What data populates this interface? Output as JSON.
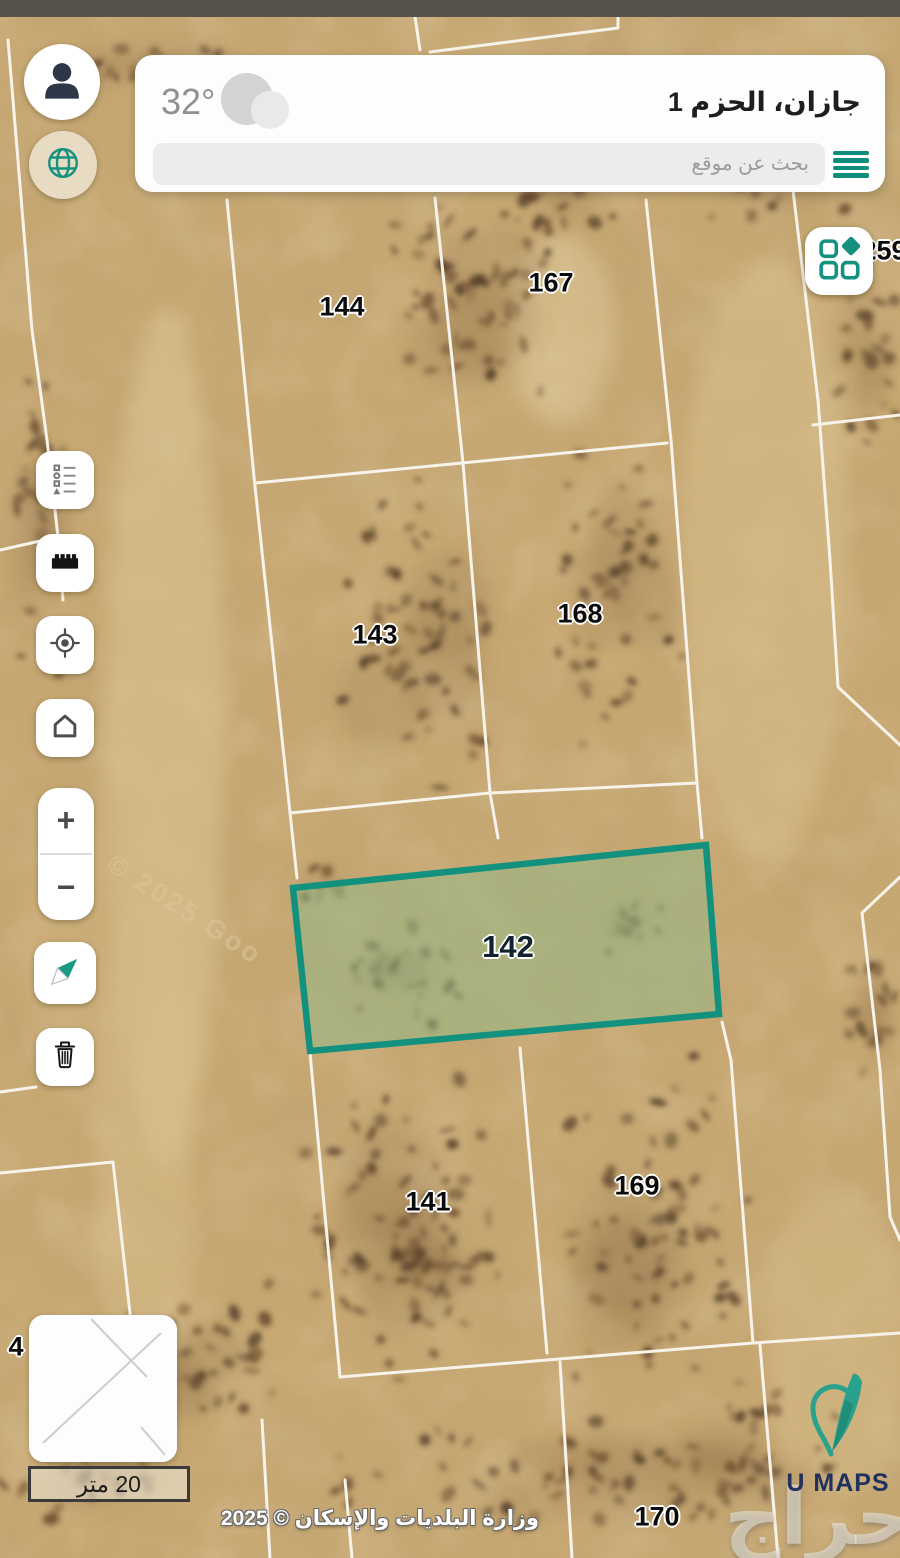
{
  "header": {
    "temperature": "32°",
    "weather_icon": "cloud-icon",
    "location_title": "جازان، الحزم 1",
    "search_placeholder": "بحث عن موقع",
    "menu_icon": "hamburger-icon"
  },
  "quick_buttons": {
    "profile_icon": "person-icon",
    "language_icon": "globe-icon"
  },
  "layers_panel": {
    "icon": "layers-grid-icon"
  },
  "toolbar": {
    "items": [
      {
        "name": "legend",
        "icon": "legend-list-icon"
      },
      {
        "name": "measure",
        "icon": "ruler-icon"
      },
      {
        "name": "locate",
        "icon": "gps-target-icon"
      },
      {
        "name": "home",
        "icon": "home-icon"
      }
    ]
  },
  "zoom_controls": {
    "zoom_in": "+",
    "zoom_out": "−"
  },
  "map_tools": {
    "compass_icon": "compass-needle-icon",
    "delete_icon": "trash-icon"
  },
  "map": {
    "parcel_labels": [
      {
        "label": "144"
      },
      {
        "label": "167"
      },
      {
        "label": "143"
      },
      {
        "label": "168"
      },
      {
        "label": "141"
      },
      {
        "label": "169"
      },
      {
        "label": "170"
      },
      {
        "label": "259"
      },
      {
        "label": "4"
      }
    ],
    "highlighted_parcel": {
      "label": "142",
      "border_color": "#12917E",
      "fill_color": "rgba(148,184,134,0.55)"
    },
    "imagery_watermark": "© 2025 Goo",
    "brand_watermark": "حراج",
    "scale_bar_label": "20 متر",
    "attribution": "وزارة البلديات والإسكان © 2025"
  },
  "branding": {
    "logo_text": "U MAPS",
    "logo_icon": "map-pin-feather-icon"
  },
  "colors": {
    "accent_teal": "#15917F",
    "sand": "#C9AA74",
    "parcel_line": "#F7F3EA",
    "highlight_fill": "#8FB581",
    "navy": "#2D3748"
  }
}
